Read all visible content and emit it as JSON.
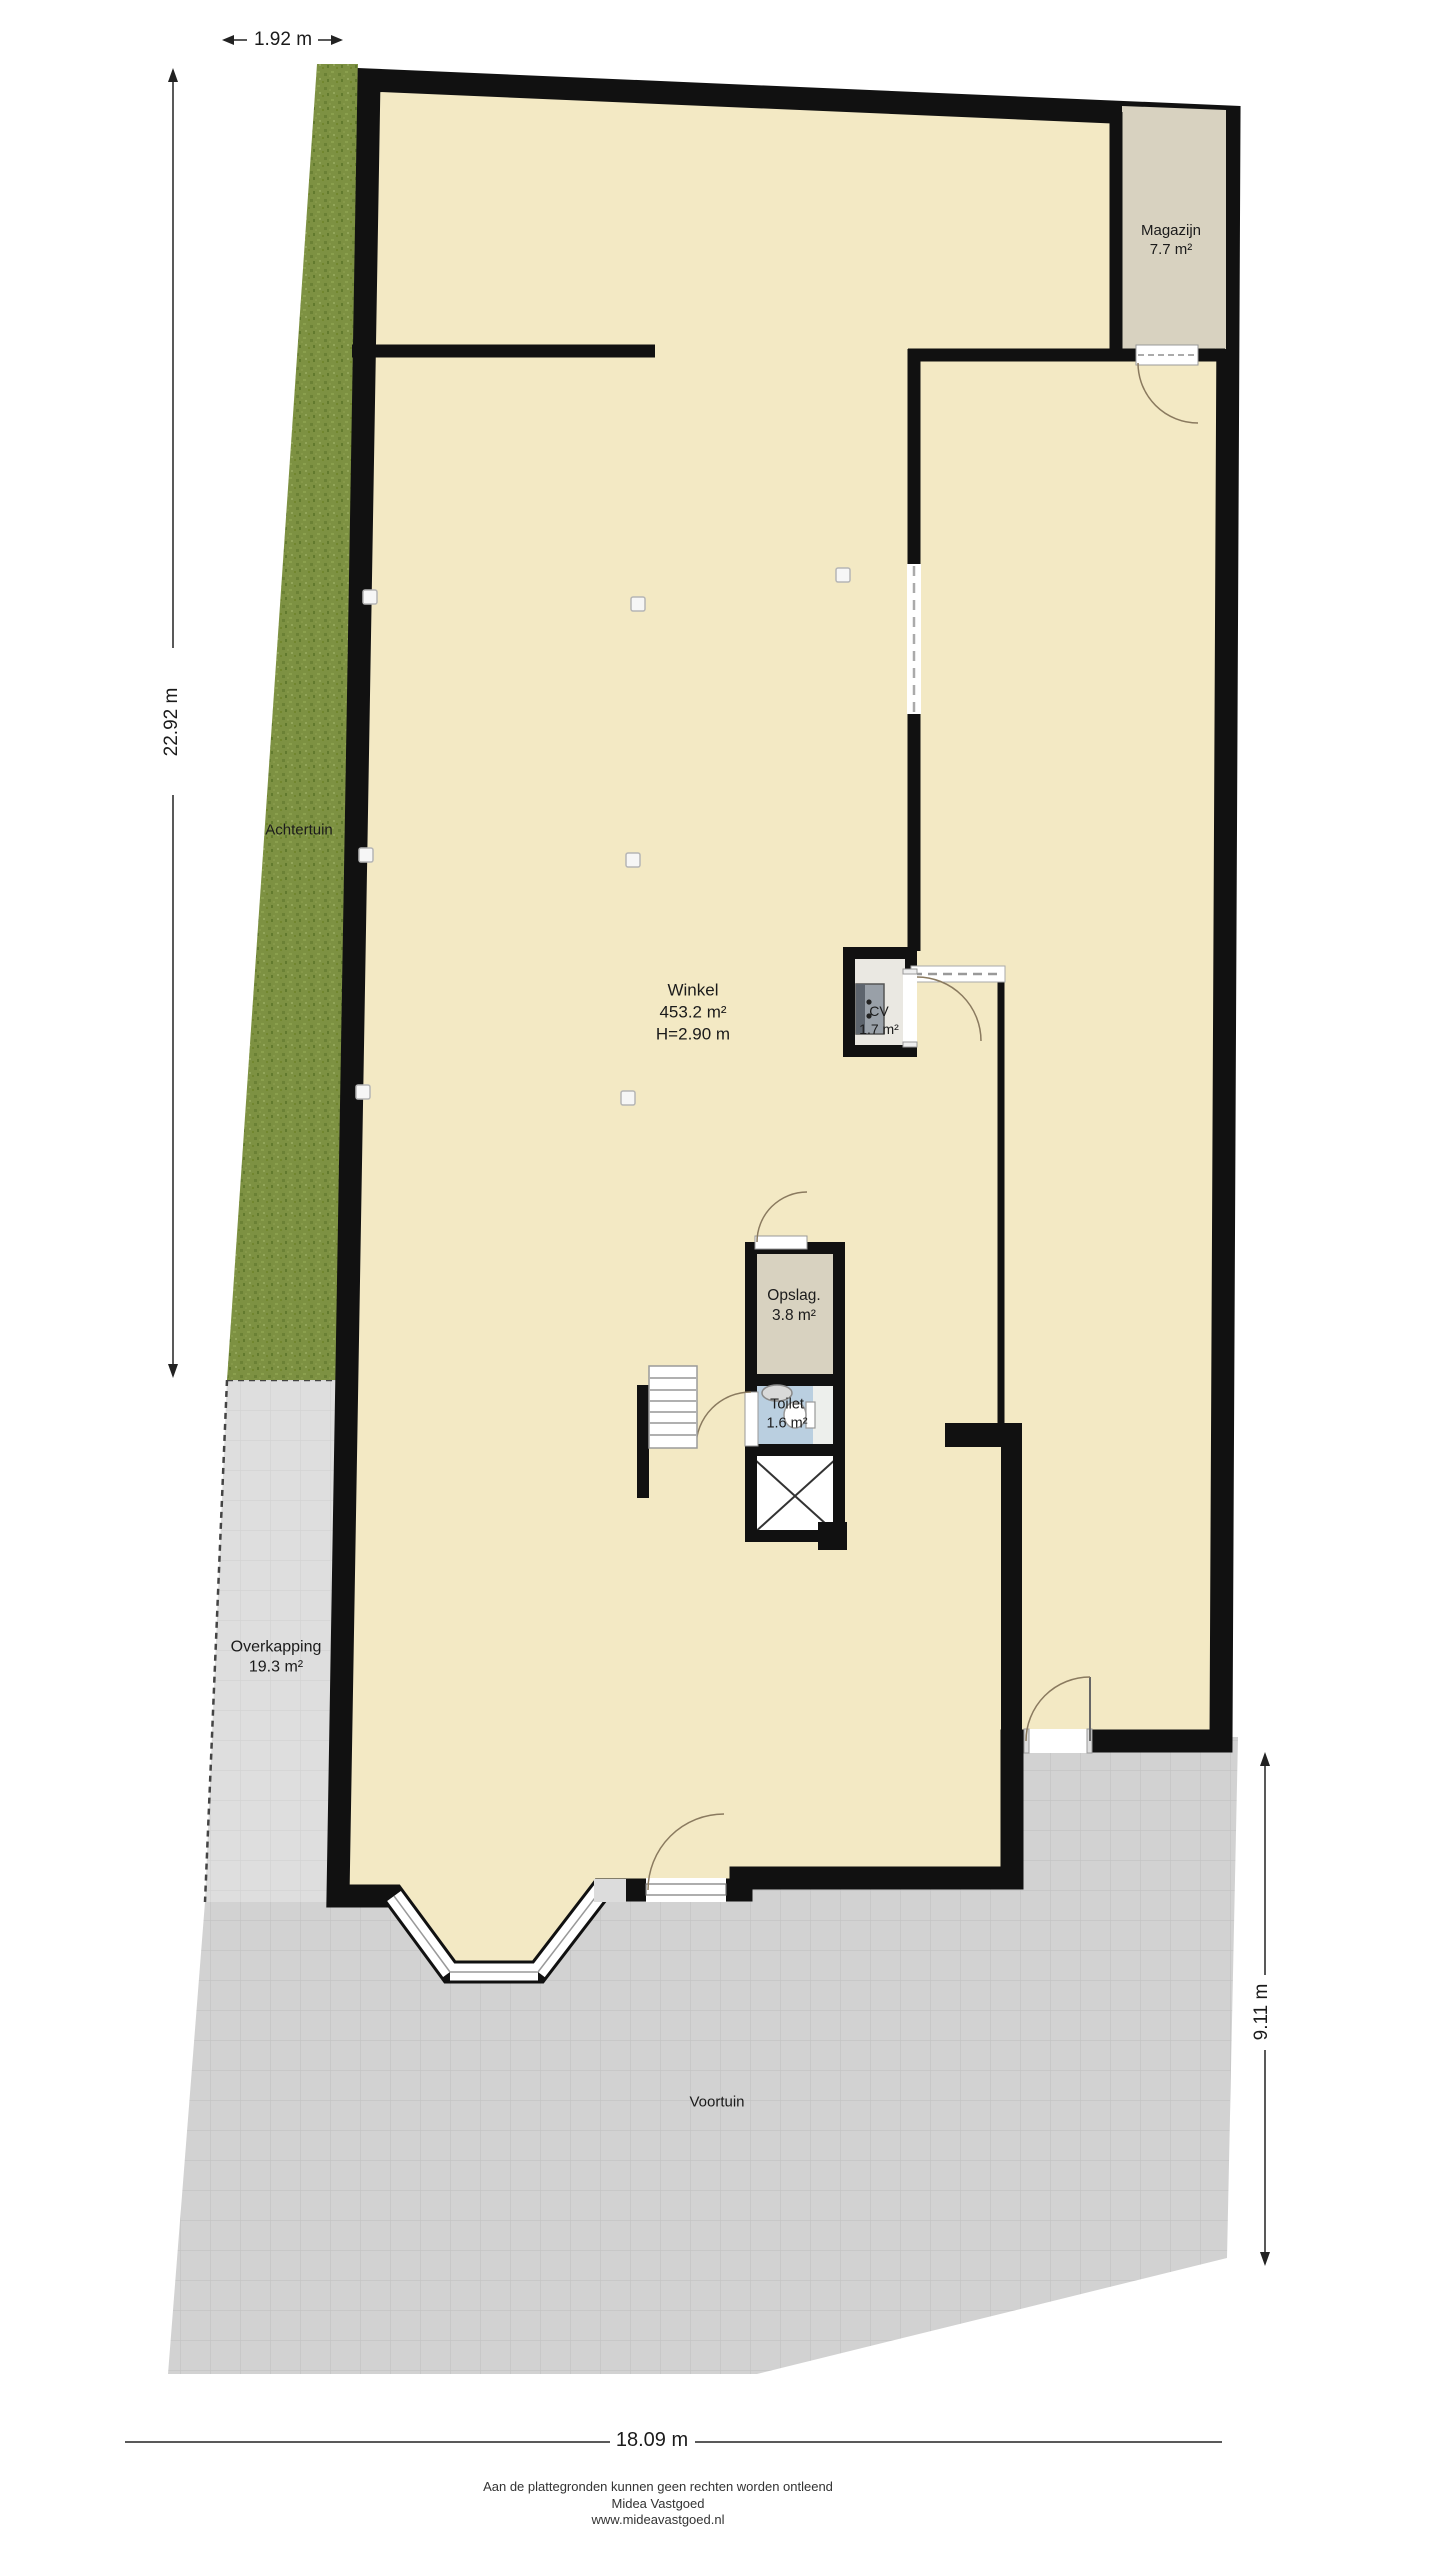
{
  "rooms": {
    "winkel": {
      "name": "Winkel",
      "area": "453.2 m²",
      "height": "H=2.90 m"
    },
    "magazijn": {
      "name": "Magazijn",
      "area": "7.7 m²"
    },
    "cv": {
      "name": "CV",
      "area": "1.7 m²"
    },
    "opslag": {
      "name": "Opslag.",
      "area": "3.8 m²"
    },
    "toilet": {
      "name": "Toilet",
      "area": "1.6 m²"
    }
  },
  "outdoor": {
    "achtertuin": {
      "name": "Achtertuin"
    },
    "overkapping": {
      "name": "Overkapping",
      "area": "19.3 m²"
    },
    "voortuin": {
      "name": "Voortuin"
    }
  },
  "dimensions": {
    "top": "1.92 m",
    "left": "22.92 m",
    "right": "9.11 m",
    "bottom": "18.09 m"
  },
  "footer": {
    "disclaimer": "Aan de plattegronden kunnen geen rechten worden ontleend",
    "company": "Midea Vastgoed",
    "website": "www.mideavastgoed.nl"
  },
  "colors": {
    "floor": "#f3e9c4",
    "wall": "#111111",
    "grass": "#7d9142",
    "tiles": "#d2d2d2",
    "storage_floor": "#d8d2c0",
    "toilet_floor": "#bacfe0",
    "cv_floor": "#eae8e2"
  }
}
